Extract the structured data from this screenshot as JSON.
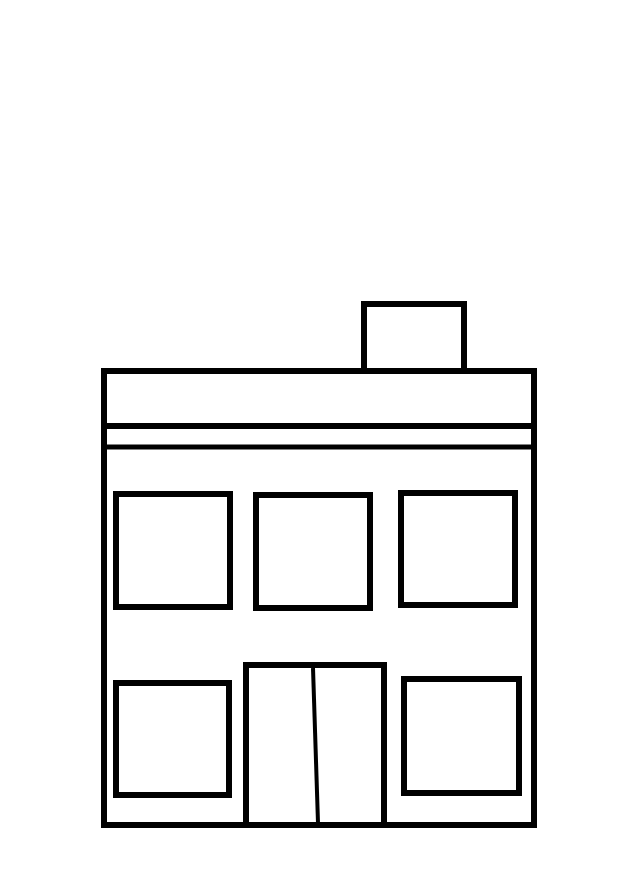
{
  "canvas": {
    "width": 640,
    "height": 881,
    "background_color": "#ffffff"
  },
  "drawing": {
    "subject": "two-story building line drawing (coloring-page style)",
    "stroke_color": "#000000",
    "fill_color": "#ffffff",
    "shapes": [
      {
        "name": "building-outline",
        "type": "rect",
        "x": 104,
        "y": 371,
        "w": 430,
        "h": 454,
        "stroke_width": 6
      },
      {
        "name": "roof-band-bottom-line",
        "type": "line",
        "x1": 101,
        "y1": 426,
        "x2": 537,
        "y2": 426,
        "stroke_width": 6
      },
      {
        "name": "fascia-trim-line",
        "type": "line",
        "x1": 101,
        "y1": 447,
        "x2": 537,
        "y2": 447,
        "stroke_width": 5
      },
      {
        "name": "chimney",
        "type": "rect",
        "x": 364,
        "y": 304,
        "w": 100,
        "h": 67,
        "stroke_width": 6
      },
      {
        "name": "upper-window-left",
        "type": "rect",
        "x": 116,
        "y": 494,
        "w": 114,
        "h": 113,
        "stroke_width": 6
      },
      {
        "name": "upper-window-middle",
        "type": "rect",
        "x": 256,
        "y": 495,
        "w": 114,
        "h": 113,
        "stroke_width": 6
      },
      {
        "name": "upper-window-right",
        "type": "rect",
        "x": 401,
        "y": 493,
        "w": 114,
        "h": 112,
        "stroke_width": 6
      },
      {
        "name": "lower-window-left",
        "type": "rect",
        "x": 116,
        "y": 683,
        "w": 113,
        "h": 112,
        "stroke_width": 6
      },
      {
        "name": "lower-window-right",
        "type": "rect",
        "x": 404,
        "y": 679,
        "w": 115,
        "h": 114,
        "stroke_width": 6
      },
      {
        "name": "door",
        "type": "rect",
        "x": 246,
        "y": 665,
        "w": 138,
        "h": 160,
        "stroke_width": 6
      },
      {
        "name": "door-center-divider",
        "type": "line",
        "x1": 313,
        "y1": 668,
        "x2": 318,
        "y2": 823,
        "stroke_width": 4
      }
    ]
  }
}
